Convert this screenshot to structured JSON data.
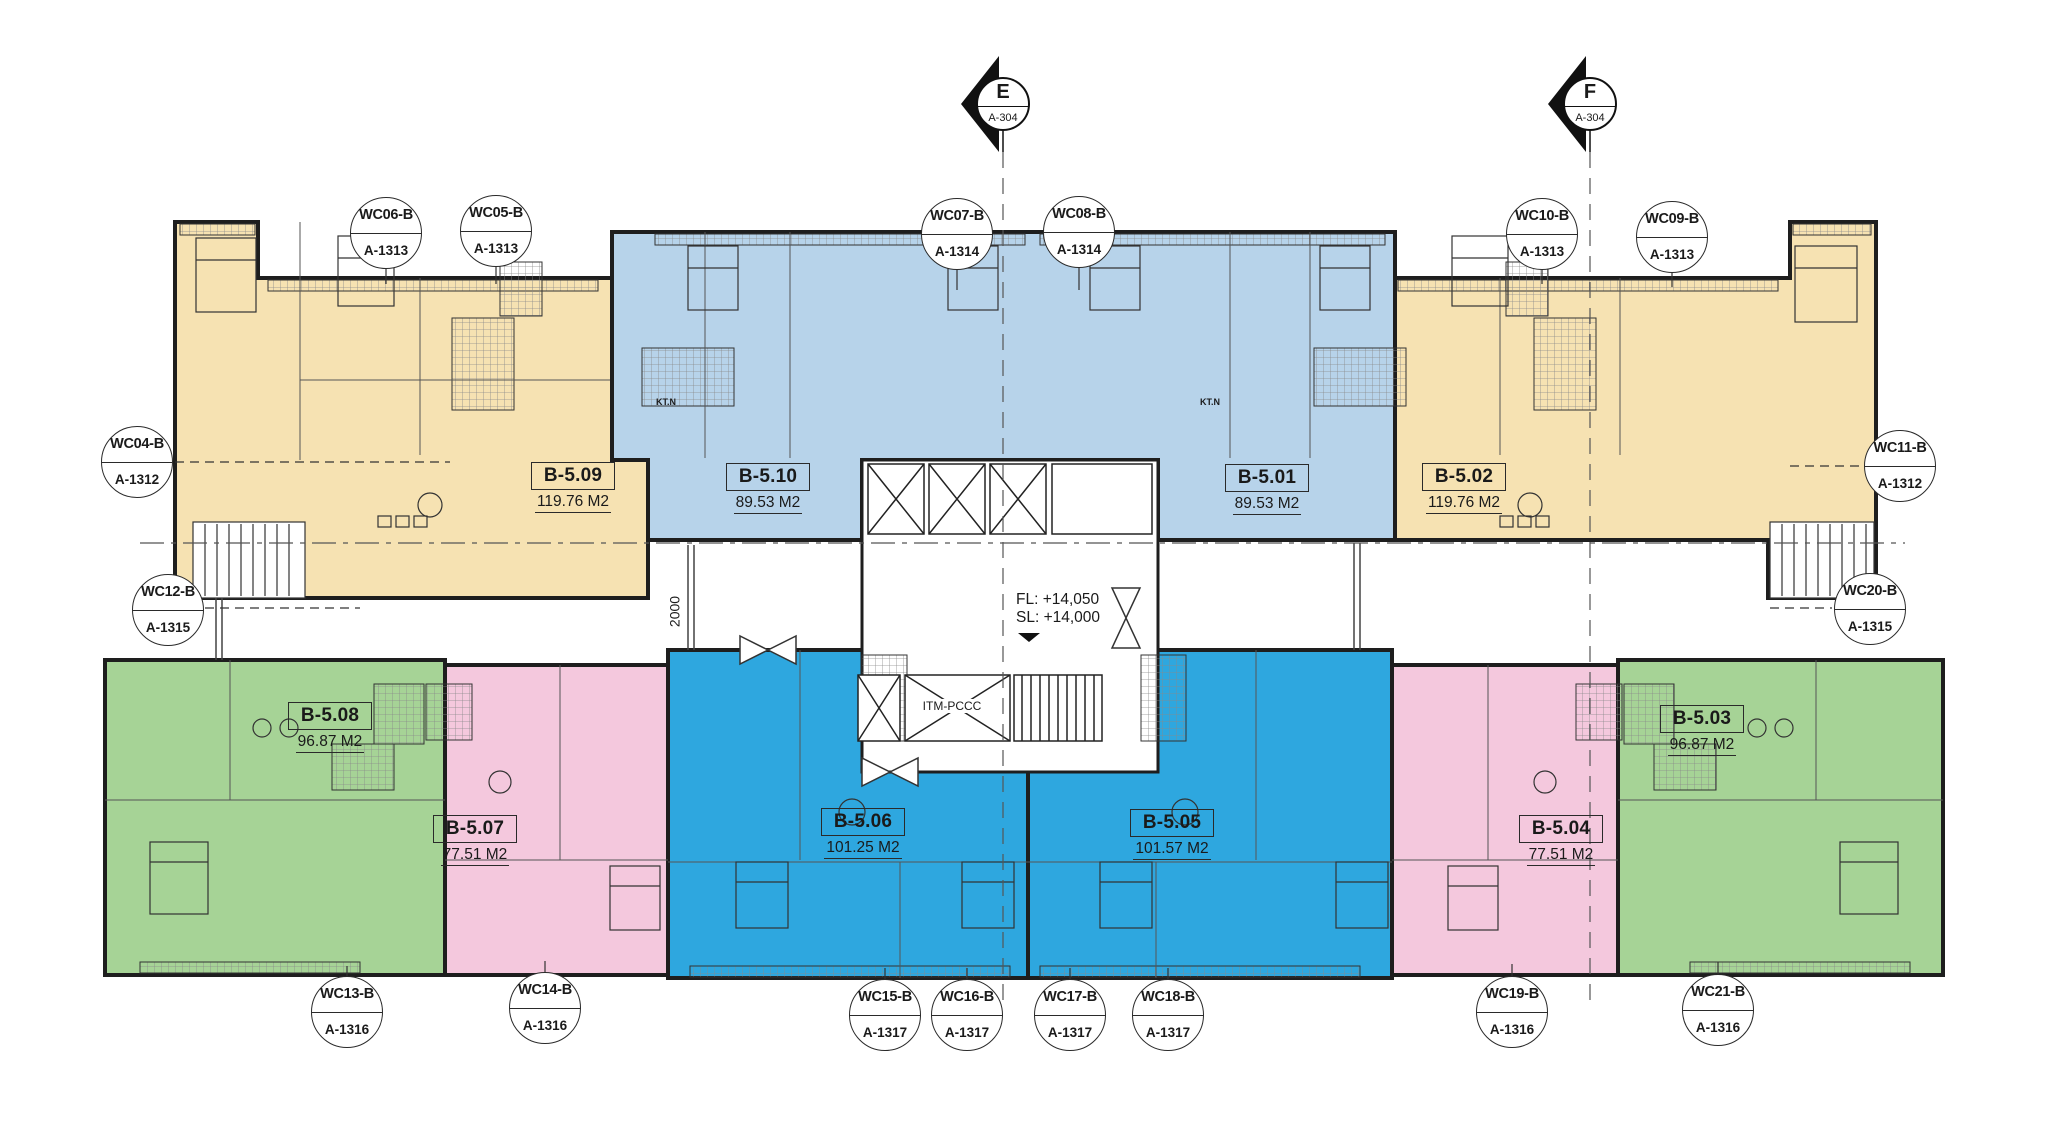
{
  "drawing": {
    "grid_markers": [
      {
        "label": "E",
        "sheet": "A-304"
      },
      {
        "label": "F",
        "sheet": "A-304"
      }
    ],
    "callouts": [
      {
        "code": "WC06-B",
        "sheet": "A-1313"
      },
      {
        "code": "WC05-B",
        "sheet": "A-1313"
      },
      {
        "code": "WC07-B",
        "sheet": "A-1314"
      },
      {
        "code": "WC08-B",
        "sheet": "A-1314"
      },
      {
        "code": "WC10-B",
        "sheet": "A-1313"
      },
      {
        "code": "WC09-B",
        "sheet": "A-1313"
      },
      {
        "code": "WC04-B",
        "sheet": "A-1312"
      },
      {
        "code": "WC11-B",
        "sheet": "A-1312"
      },
      {
        "code": "WC12-B",
        "sheet": "A-1315"
      },
      {
        "code": "WC20-B",
        "sheet": "A-1315"
      },
      {
        "code": "WC13-B",
        "sheet": "A-1316"
      },
      {
        "code": "WC14-B",
        "sheet": "A-1316"
      },
      {
        "code": "WC15-B",
        "sheet": "A-1317"
      },
      {
        "code": "WC16-B",
        "sheet": "A-1317"
      },
      {
        "code": "WC17-B",
        "sheet": "A-1317"
      },
      {
        "code": "WC18-B",
        "sheet": "A-1317"
      },
      {
        "code": "WC19-B",
        "sheet": "A-1316"
      },
      {
        "code": "WC21-B",
        "sheet": "A-1316"
      }
    ],
    "units": [
      {
        "code": "B-5.09",
        "area": "119.76 M2"
      },
      {
        "code": "B-5.10",
        "area": "89.53 M2"
      },
      {
        "code": "B-5.01",
        "area": "89.53 M2"
      },
      {
        "code": "B-5.02",
        "area": "119.76 M2"
      },
      {
        "code": "B-5.08",
        "area": "96.87 M2"
      },
      {
        "code": "B-5.07",
        "area": "77.51 M2"
      },
      {
        "code": "B-5.06",
        "area": "101.25 M2"
      },
      {
        "code": "B-5.05",
        "area": "101.57 M2"
      },
      {
        "code": "B-5.04",
        "area": "77.51 M2"
      },
      {
        "code": "B-5.03",
        "area": "96.87 M2"
      }
    ],
    "core": {
      "itm_label": "ITM-PCCC",
      "fl_text": "FL: +14,050",
      "sl_text": "SL: +14,000"
    },
    "tech_labels": [
      {
        "text": "KT.N"
      },
      {
        "text": "KT.N"
      }
    ],
    "dimension": {
      "value": "2000"
    }
  },
  "colors": {
    "tan": "#F6E2B2",
    "light_blue": "#B7D3EA",
    "dark_blue": "#2EA7DF",
    "green": "#A6D396",
    "pink": "#F4C8DD",
    "wall": "#1E1E1E",
    "white": "#FFFFFF"
  }
}
